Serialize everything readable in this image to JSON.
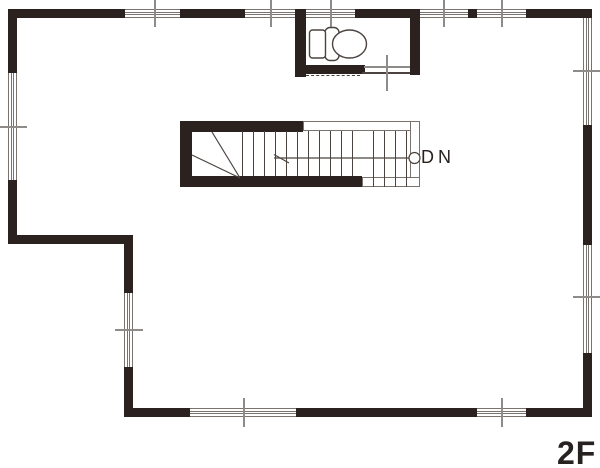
{
  "floorplan": {
    "floor_label": "2F",
    "stair": {
      "direction_label": "DN"
    },
    "icons": {
      "toilet": "toilet-icon",
      "stair_direction": "stair-down-arrow-icon",
      "window_mark": "window-center-tick"
    },
    "colors": {
      "wall": "#2b211e",
      "line": "#4b433f",
      "tick": "#8f8b88",
      "frame": "#7a736d",
      "text": "#272220",
      "bg": "#ffffff"
    }
  }
}
